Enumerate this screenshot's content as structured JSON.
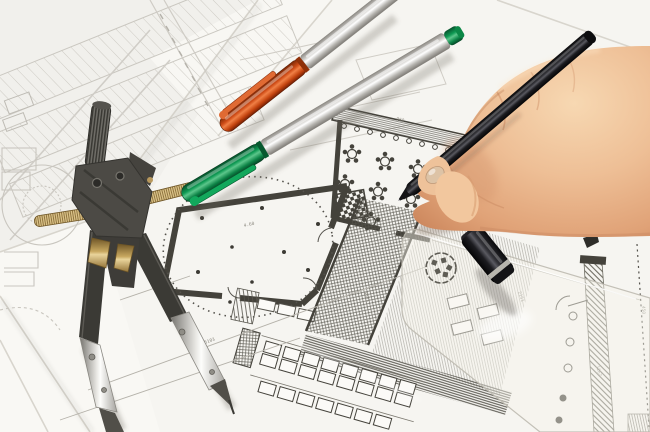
{
  "meta": {
    "title": "Architect working on floor plans",
    "description": "Photo-style scene: a right hand drawing with a black pen on architectural floor plans, with a drafting compass, two capped marker pens, a transparent set square and a black pen cap on overlapping blueprint sheets"
  },
  "scene": {
    "objects": [
      {
        "name": "drafting-compass",
        "description": "dark drafting compass / divider with knurled stem, brass adjustment screw and two splayed metal-tipped legs"
      },
      {
        "name": "orange-marker",
        "description": "silver marker pen with orange cap, lying diagonally"
      },
      {
        "name": "green-marker",
        "description": "silver marker pen with green cap and green end plug, lying diagonally"
      },
      {
        "name": "black-pen",
        "description": "black fineliner pen held in a right hand, tip touching the plan"
      },
      {
        "name": "hand",
        "description": "right hand gripping the black pen, entering from the right edge"
      },
      {
        "name": "pen-cap",
        "description": "black pen cap with a grey ring, lying on the transparent set square"
      },
      {
        "name": "set-square",
        "description": "transparent acrylic set square with embossed circular logo"
      },
      {
        "name": "floor-plans",
        "description": "overlapping plan sheets: ballroom with dotted circle, restaurant room with round tables, hatched corridors, parking rows, faint site plan"
      }
    ]
  },
  "plan": {
    "dimension_labels": {
      "a": "5103",
      "b": "960",
      "c": "4.60",
      "d": "2151",
      "e": "1267",
      "f": "4501",
      "g": "450"
    }
  },
  "palette": {
    "paper": "#f6f5f1",
    "paper_shadow": "#d8d5cd",
    "plan_ink": "#44423b",
    "plan_faint": "#c9c6bf",
    "skin": "#eebf96",
    "orange_cap": "#d9511c",
    "green_cap": "#0f9a54",
    "silver_barrel": "#d8d6d2",
    "black_pen": "#141416",
    "brass": "#c8a860"
  }
}
